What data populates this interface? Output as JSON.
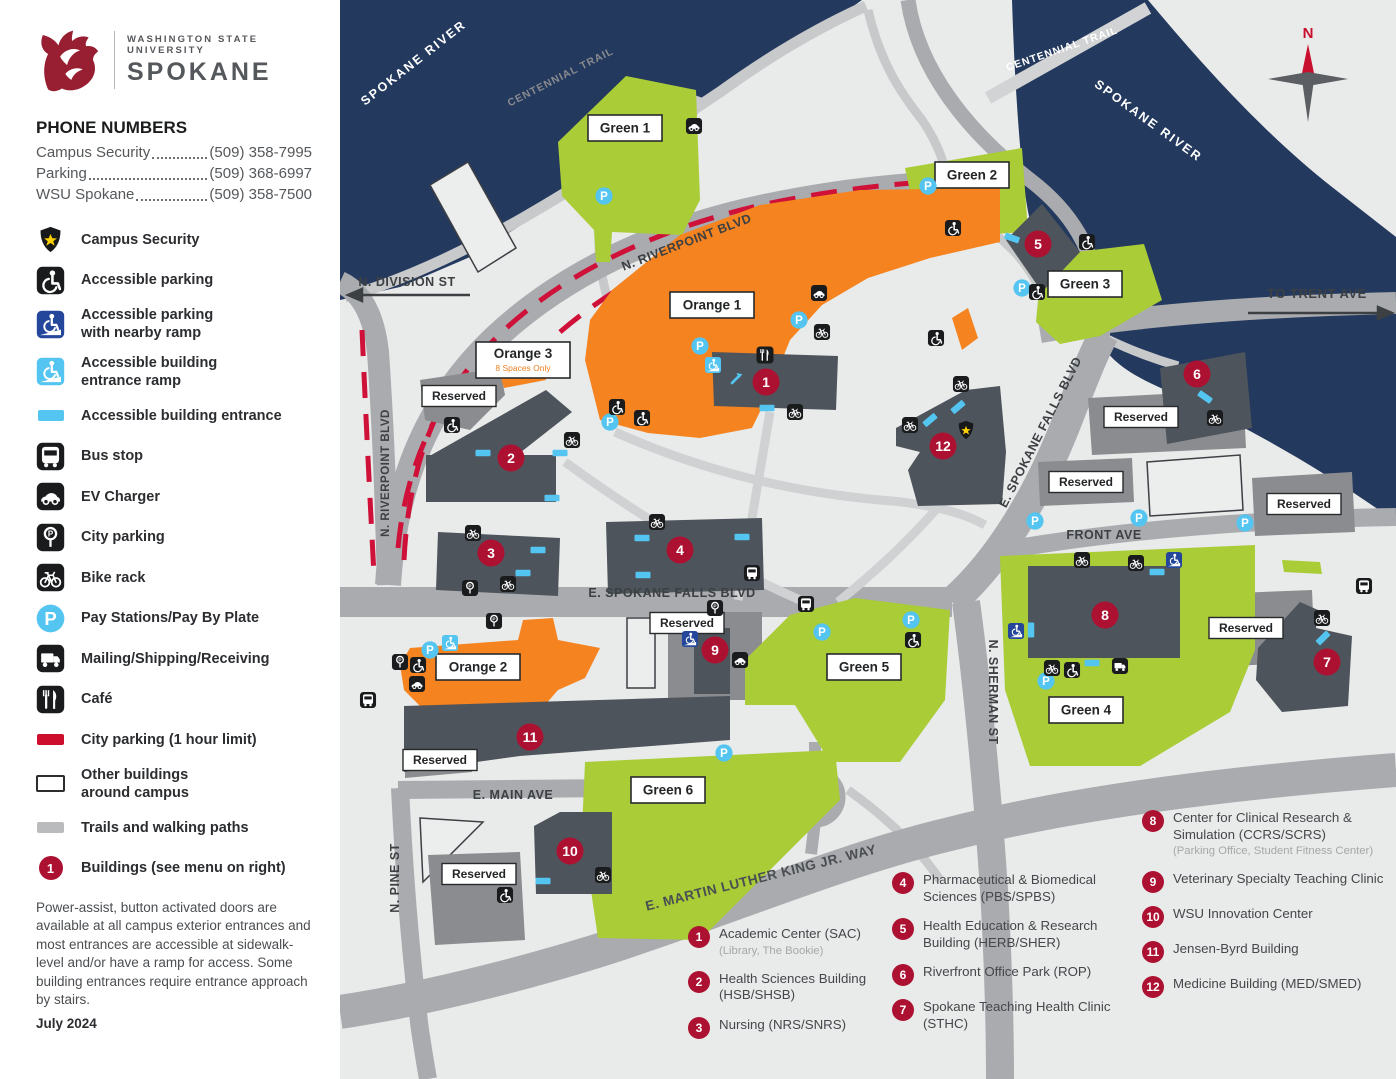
{
  "sidebar": {
    "logo": {
      "institution": "WASHINGTON STATE UNIVERSITY",
      "campus": "SPOKANE"
    },
    "phone": {
      "heading": "PHONE NUMBERS",
      "entries": [
        {
          "label": "Campus Security",
          "number": "(509) 358-7995"
        },
        {
          "label": "Parking",
          "number": "(509) 368-6997"
        },
        {
          "label": "WSU Spokane",
          "number": "(509) 358-7500"
        }
      ]
    },
    "legend": [
      {
        "icon": "badge",
        "label": "Campus Security"
      },
      {
        "icon": "accessible",
        "label": "Accessible parking"
      },
      {
        "icon": "ramp-dark",
        "label": "Accessible parking",
        "label2": "with nearby ramp"
      },
      {
        "icon": "ramp-light",
        "label": "Accessible building",
        "label2": "entrance ramp"
      },
      {
        "icon": "entrance",
        "label": "Accessible building entrance"
      },
      {
        "icon": "bus",
        "label": "Bus stop"
      },
      {
        "icon": "ev",
        "label": "EV Charger"
      },
      {
        "icon": "meter",
        "label": "City parking"
      },
      {
        "icon": "bike",
        "label": "Bike rack"
      },
      {
        "icon": "pay",
        "label": "Pay Stations/Pay By Plate"
      },
      {
        "icon": "truck",
        "label": "Mailing/Shipping/Receiving"
      },
      {
        "icon": "cafe",
        "label": "Café"
      },
      {
        "icon": "chip-red",
        "label": "City parking (1 hour limit)"
      },
      {
        "icon": "chip-outline",
        "label": "Other buildings",
        "label2": "around campus"
      },
      {
        "icon": "chip-gray",
        "label": "Trails and walking paths"
      },
      {
        "icon": "marker1",
        "badge": "1",
        "label": "Buildings (see menu on right)"
      }
    ],
    "note": "Power-assist, button activated doors are available at all campus exterior entrances and most entrances are accessible at sidewalk-level and/or have a ramp for access. Some building entrances require entrance approach by stairs.",
    "date": "July 2024"
  },
  "map": {
    "compass_label": "N",
    "reserved_label": "Reserved",
    "reserved_boxes": [
      [
        459,
        396
      ],
      [
        687,
        623
      ],
      [
        440,
        760
      ],
      [
        479,
        874
      ],
      [
        1141,
        417
      ],
      [
        1086,
        482
      ],
      [
        1304,
        504
      ],
      [
        1246,
        628
      ]
    ],
    "road_labels": [
      {
        "t": "SPOKANE RIVER",
        "x": 416,
        "y": 66,
        "r": -38,
        "s": 12.5,
        "w": true,
        "ls": 2
      },
      {
        "t": "CENTENNIAL TRAIL",
        "x": 562,
        "y": 80,
        "r": -27,
        "s": 10.5,
        "c": "#898b8e",
        "ls": 1
      },
      {
        "t": "N. RIVERPOINT BLVD",
        "x": 688,
        "y": 246,
        "r": -21,
        "s": 12.5
      },
      {
        "t": "N. RIVERPOINT BLVD",
        "x": 389,
        "y": 473,
        "r": -90,
        "s": 11.5
      },
      {
        "t": "CENTENNIAL TRAIL",
        "x": 1063,
        "y": 52,
        "r": -19,
        "s": 10.5,
        "w": true,
        "ls": 1
      },
      {
        "t": "SPOKANE RIVER",
        "x": 1146,
        "y": 124,
        "r": 36,
        "s": 12.5,
        "w": true,
        "ls": 2
      },
      {
        "t": "N. DIVISION ST",
        "x": 407,
        "y": 286,
        "s": 12.5
      },
      {
        "t": "TO TRENT AVE",
        "x": 1317,
        "y": 298,
        "s": 13
      },
      {
        "t": "E. SPOKANE FALLS BLVD",
        "x": 672,
        "y": 597,
        "s": 12.5
      },
      {
        "t": "E. SPOKANE FALLS BLVD",
        "x": 1044,
        "y": 434,
        "r": -63,
        "s": 12.5
      },
      {
        "t": "FRONT AVE",
        "x": 1104,
        "y": 539,
        "s": 12.5
      },
      {
        "t": "N. SHERMAN ST",
        "x": 989,
        "y": 692,
        "r": 90,
        "s": 12.5
      },
      {
        "t": "E. MAIN AVE",
        "x": 513,
        "y": 799,
        "s": 12.5
      },
      {
        "t": "N. PINE ST",
        "x": 399,
        "y": 878,
        "r": -90,
        "s": 12.5
      },
      {
        "t": "E. MARTIN LUTHER KING JR. WAY",
        "x": 762,
        "y": 882,
        "r": -14,
        "s": 13.5,
        "c": "#4a4e52"
      }
    ],
    "lot_labels": [
      {
        "t": "Green 1",
        "x": 625,
        "y": 128,
        "w": 74
      },
      {
        "t": "Green 2",
        "x": 972,
        "y": 175,
        "w": 74
      },
      {
        "t": "Green 3",
        "x": 1085,
        "y": 284,
        "w": 74
      },
      {
        "t": "Green 4",
        "x": 1086,
        "y": 710,
        "w": 74
      },
      {
        "t": "Green 5",
        "x": 864,
        "y": 667,
        "w": 74
      },
      {
        "t": "Green 6",
        "x": 668,
        "y": 790,
        "w": 74
      },
      {
        "t": "Orange 1",
        "x": 712,
        "y": 305,
        "w": 84
      },
      {
        "t": "Orange 2",
        "x": 478,
        "y": 667,
        "w": 84
      },
      {
        "t": "Orange 3",
        "x": 523,
        "y": 360,
        "w": 94,
        "sub": "8 Spaces Only"
      }
    ],
    "building_markers": [
      {
        "num": "1",
        "x": 766,
        "y": 382
      },
      {
        "num": "2",
        "x": 511,
        "y": 458
      },
      {
        "num": "3",
        "x": 491,
        "y": 553
      },
      {
        "num": "4",
        "x": 680,
        "y": 550
      },
      {
        "num": "5",
        "x": 1038,
        "y": 244
      },
      {
        "num": "6",
        "x": 1197,
        "y": 374
      },
      {
        "num": "7",
        "x": 1327,
        "y": 662
      },
      {
        "num": "8",
        "x": 1105,
        "y": 615
      },
      {
        "num": "9",
        "x": 715,
        "y": 650
      },
      {
        "num": "10",
        "x": 570,
        "y": 851
      },
      {
        "num": "11",
        "x": 530,
        "y": 737
      },
      {
        "num": "12",
        "x": 943,
        "y": 446
      }
    ],
    "icons": [
      {
        "type": "pay",
        "pts": [
          [
            604,
            196
          ],
          [
            928,
            186
          ],
          [
            799,
            320
          ],
          [
            700,
            346
          ],
          [
            610,
            422
          ],
          [
            1022,
            288
          ],
          [
            430,
            650
          ],
          [
            822,
            632
          ],
          [
            724,
            753
          ],
          [
            911,
            620
          ],
          [
            1046,
            681
          ],
          [
            1035,
            521
          ],
          [
            1139,
            518
          ],
          [
            1245,
            523
          ]
        ]
      },
      {
        "type": "accessible",
        "pts": [
          [
            953,
            228
          ],
          [
            1087,
            242
          ],
          [
            1037,
            292
          ],
          [
            452,
            425
          ],
          [
            617,
            407
          ],
          [
            642,
            418
          ],
          [
            418,
            665
          ],
          [
            505,
            895
          ],
          [
            913,
            640
          ],
          [
            1072,
            670
          ],
          [
            936,
            338
          ]
        ]
      },
      {
        "type": "ramp-dark",
        "pts": [
          [
            690,
            639
          ],
          [
            1016,
            631
          ],
          [
            1174,
            560
          ]
        ]
      },
      {
        "type": "ramp-light",
        "pts": [
          [
            713,
            365
          ],
          [
            450,
            643
          ]
        ]
      },
      {
        "type": "bus",
        "pts": [
          [
            368,
            700
          ],
          [
            806,
            604
          ],
          [
            752,
            573
          ],
          [
            1364,
            586
          ]
        ]
      },
      {
        "type": "bike",
        "pts": [
          [
            822,
            332
          ],
          [
            795,
            412
          ],
          [
            572,
            440
          ],
          [
            473,
            533
          ],
          [
            508,
            584
          ],
          [
            657,
            522
          ],
          [
            603,
            875
          ],
          [
            961,
            384
          ],
          [
            910,
            425
          ],
          [
            1082,
            560
          ],
          [
            1136,
            563
          ],
          [
            1322,
            618
          ],
          [
            1052,
            668
          ],
          [
            1215,
            418
          ]
        ]
      },
      {
        "type": "ev",
        "pts": [
          [
            694,
            126
          ],
          [
            819,
            293
          ],
          [
            417,
            684
          ],
          [
            740,
            660
          ]
        ]
      },
      {
        "type": "meter",
        "pts": [
          [
            470,
            588
          ],
          [
            494,
            621
          ],
          [
            400,
            662
          ],
          [
            715,
            608
          ]
        ]
      },
      {
        "type": "cafe",
        "pts": [
          [
            765,
            355
          ]
        ]
      },
      {
        "type": "badge",
        "pts": [
          [
            966,
            430
          ]
        ]
      },
      {
        "type": "truck",
        "pts": [
          [
            1120,
            666
          ]
        ]
      },
      {
        "type": "arrow",
        "pts": [
          [
            737,
            378
          ]
        ]
      },
      {
        "type": "entrance",
        "pts": [
          [
            767,
            408
          ],
          [
            483,
            453
          ],
          [
            560,
            453
          ],
          [
            552,
            498
          ],
          [
            538,
            550
          ],
          [
            523,
            573
          ],
          [
            642,
            538
          ],
          [
            742,
            537
          ],
          [
            643,
            575
          ],
          [
            958,
            407,
            -40
          ],
          [
            930,
            420,
            -40
          ],
          [
            1205,
            397,
            35
          ],
          [
            1157,
            572
          ],
          [
            1092,
            663
          ],
          [
            1323,
            638,
            -45
          ],
          [
            543,
            881
          ],
          [
            1031,
            630,
            90
          ],
          [
            1012,
            238,
            20
          ]
        ]
      }
    ]
  },
  "building_menu": {
    "columns": [
      [
        {
          "num": "1",
          "name": "Academic Center (SAC)",
          "sub": "(Library, The Bookie)"
        },
        {
          "num": "2",
          "name": "Health Sciences Building (HSB/SHSB)"
        },
        {
          "num": "3",
          "name": "Nursing (NRS/SNRS)"
        }
      ],
      [
        {
          "num": "4",
          "name": "Pharmaceutical & Biomedical Sciences (PBS/SPBS)"
        },
        {
          "num": "5",
          "name": "Health Education & Research Building (HERB/SHER)"
        },
        {
          "num": "6",
          "name": "Riverfront Office Park (ROP)"
        },
        {
          "num": "7",
          "name": "Spokane Teaching Health Clinic (STHC)"
        }
      ],
      [
        {
          "num": "8",
          "name": "Center for Clinical Research & Simulation (CCRS/SCRS)",
          "sub": "(Parking Office, Student Fitness Center)"
        },
        {
          "num": "9",
          "name": "Veterinary Specialty Teaching Clinic"
        },
        {
          "num": "10",
          "name": "WSU Innovation Center"
        },
        {
          "num": "11",
          "name": "Jensen-Byrd Building"
        },
        {
          "num": "12",
          "name": "Medicine Building (MED/SMED)"
        }
      ]
    ]
  }
}
